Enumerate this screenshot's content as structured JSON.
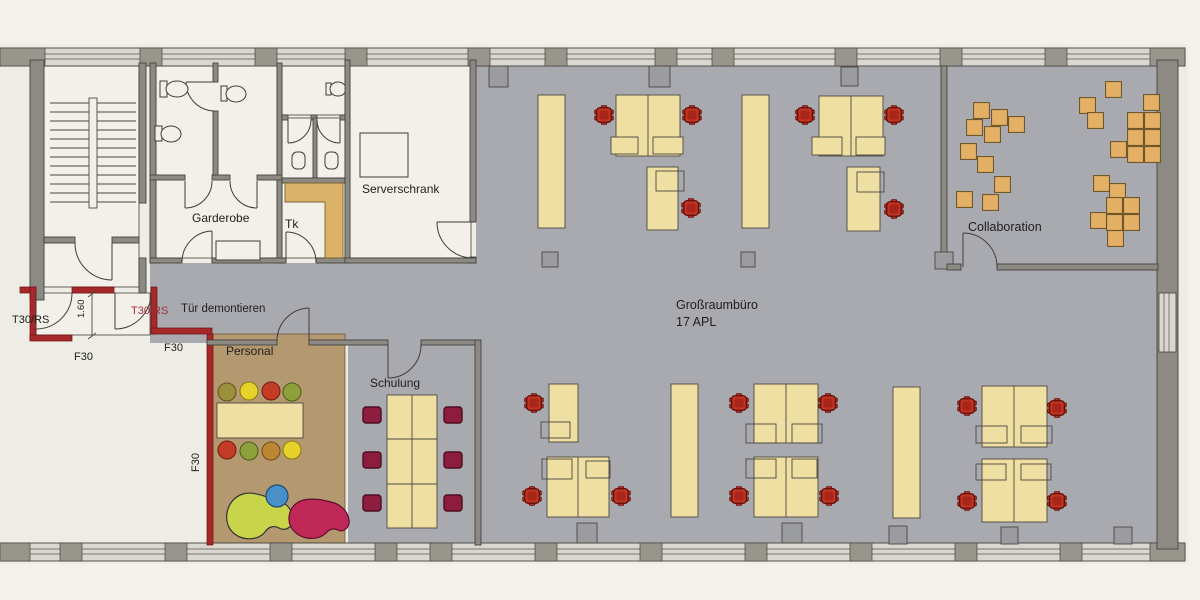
{
  "plan": {
    "rooms": {
      "garderobe": {
        "label": "Garderobe"
      },
      "tk": {
        "label": "Tk"
      },
      "serverschrank": {
        "label": "Serverschrank"
      },
      "personal": {
        "label": "Personal"
      },
      "schulung": {
        "label": "Schulung"
      },
      "grossraumbuero": {
        "label": "Großraumbüro",
        "subtitle": "17 APL"
      },
      "collaboration": {
        "label": "Collaboration"
      }
    },
    "fire_protection": {
      "door_label_1": "T30/RS",
      "door_label_2": "T30/RS",
      "wall_label_1": "F30",
      "wall_label_2": "F30",
      "wall_label_3": "F30"
    },
    "annotations": {
      "remove_door": "Tür demontieren",
      "door_width": "1.60"
    },
    "colors": {
      "floor_open_office": "#a8aab0",
      "floor_personal": "#b49870",
      "desk_yellow": "#f0dfa2",
      "office_chair_red": "#c23424",
      "training_chair_maroon": "#8c1d3f",
      "collab_cube_orange": "#e3b066",
      "fire_wall_red": "#a62828",
      "wall_gray": "#8d8a83",
      "tea_counter_orange": "#dcb269"
    }
  }
}
